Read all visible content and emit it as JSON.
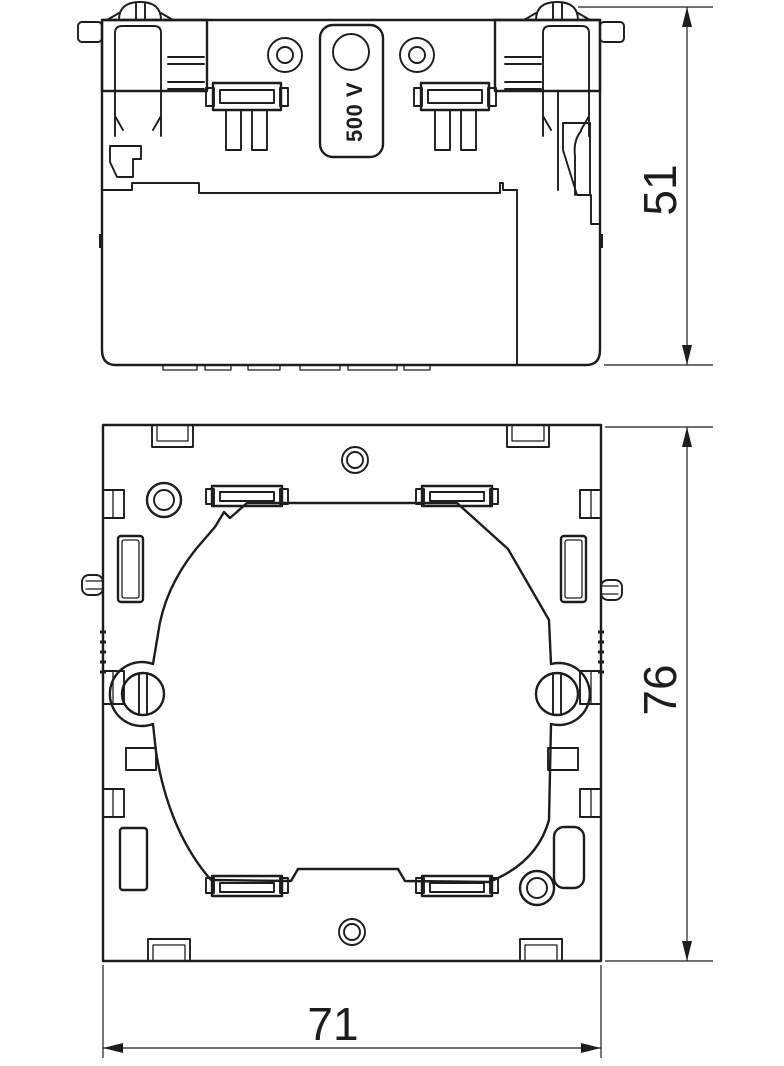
{
  "drawing": {
    "voltage_label": "500 V",
    "dimensions": {
      "side_view_height": "51",
      "front_view_height": "76",
      "front_view_width": "71"
    },
    "colors": {
      "line": "#1d1d1b",
      "background": "#ffffff"
    }
  }
}
